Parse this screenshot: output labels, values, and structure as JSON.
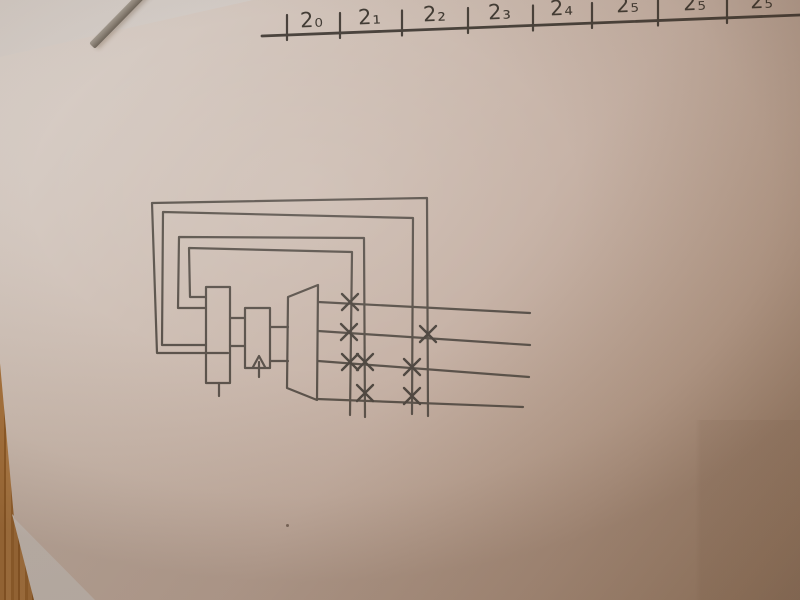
{
  "header": {
    "cells": [
      {
        "label": "2₀"
      },
      {
        "label": "2₁"
      },
      {
        "label": "2₂"
      },
      {
        "label": "2₃"
      },
      {
        "label": "2₄"
      },
      {
        "label": "2₅"
      },
      {
        "label": "2₅"
      },
      {
        "label": "2₅"
      }
    ],
    "tick_count": 8
  },
  "diagram": {
    "feedback_loops": 4,
    "output_lines": 4,
    "junction_marks": 8,
    "blocks": [
      "register-block",
      "clock-block",
      "converter-trapezoid"
    ]
  },
  "colors": {
    "pencil": "#534c45",
    "pencil_dark": "#3c3731",
    "paper_light": "#dad2cc",
    "paper_shadow": "#977d69",
    "underlying_paper": "#d6cfca",
    "wood": "#a8743e",
    "stick_gray": "#8d8479"
  }
}
